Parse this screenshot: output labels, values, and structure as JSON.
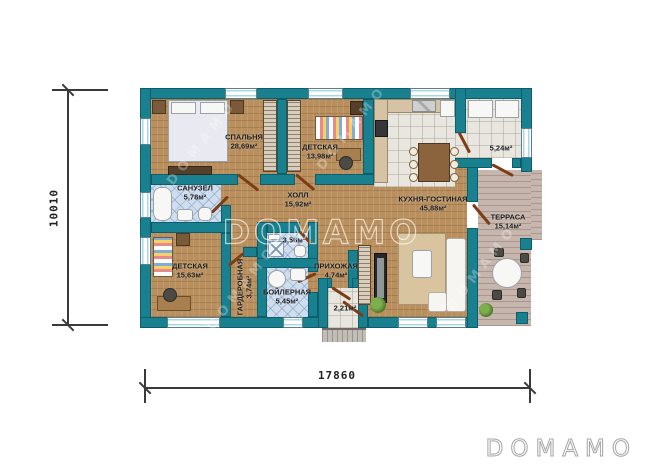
{
  "watermark": {
    "center": "DOMAMO",
    "diagonal": "DOMAMO"
  },
  "brand": {
    "logo": "DOMAMO"
  },
  "dimensions": {
    "horizontal": "17860",
    "vertical": "10010"
  },
  "rooms": {
    "bedroom": {
      "name": "СПАЛЬНЯ",
      "area": "28,69м²"
    },
    "kids1": {
      "name": "ДЕТСКАЯ",
      "area": "13,98м²"
    },
    "sanuzel": {
      "name": "САНУЗЕЛ",
      "area": "5,78м²"
    },
    "hall": {
      "name": "ХОЛЛ",
      "area": "15,92м²"
    },
    "kitchen_living": {
      "name": "КУХНЯ-ГОСТИНАЯ",
      "area": "45,88м²"
    },
    "kids2": {
      "name": "ДЕТСКАЯ",
      "area": "15,63м²"
    },
    "wardrobe": {
      "name": "ГАРДЕРОБНАЯ",
      "area": "3,74м²"
    },
    "wc_small": {
      "area": "3,56м²"
    },
    "boiler": {
      "name": "БОЙЛЕРНАЯ",
      "area": "5,45м²"
    },
    "entry_hall": {
      "name": "ПРИХОЖАЯ",
      "area": "4,74м²"
    },
    "tambour": {
      "area": "5,24м²"
    },
    "porch": {
      "area": "2,21м²"
    },
    "terrace": {
      "name": "ТЕРРАСА",
      "area": "15,14м²"
    }
  },
  "colors": {
    "wall": "#19808F",
    "wood_floor": "#B98F5D",
    "tile_floor": "#E9E6DF",
    "bath_tile": "#CFDEEF",
    "terrace_deck": "#C7B6AD",
    "door": "#7C3D14"
  }
}
